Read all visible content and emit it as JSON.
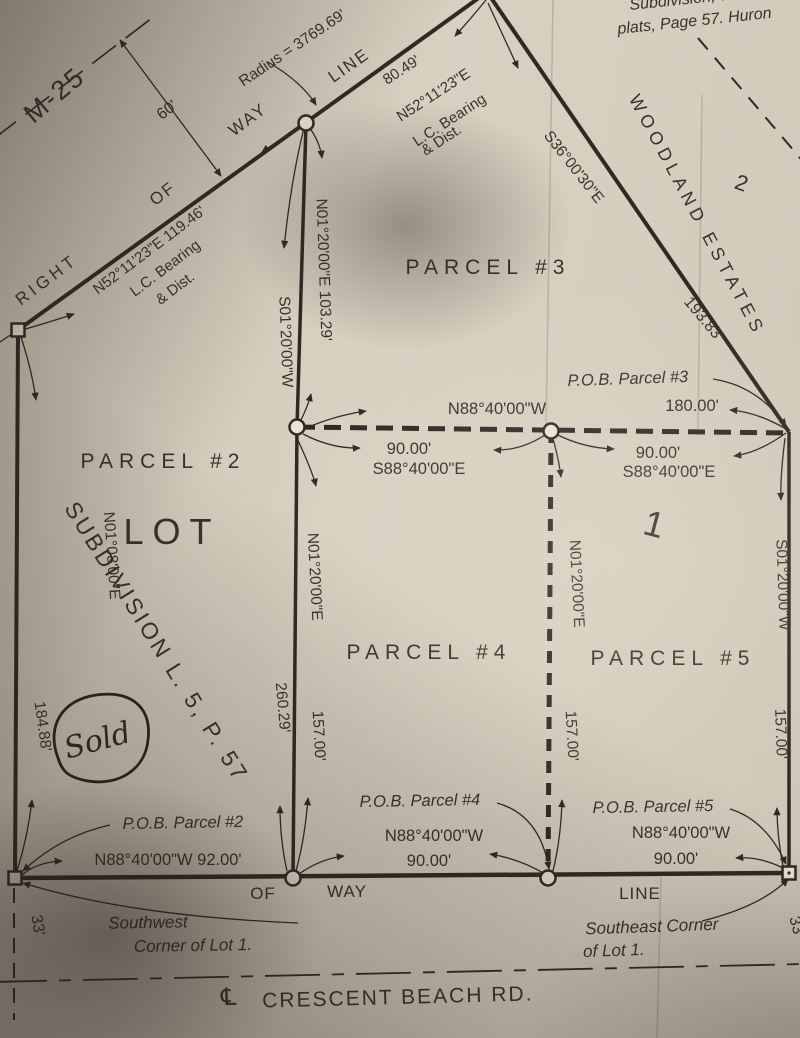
{
  "m25_road": {
    "name": "M-25",
    "right": "RIGHT",
    "of": "OF",
    "way": "WAY",
    "line": "LINE",
    "offset": "60'",
    "radius": "Radius = 3769.69'",
    "curve1": {
      "bearing_dist": "N52°11'23\"E  119.46'",
      "note1": "L.C. Bearing",
      "note2": "& Dist."
    },
    "curve2": {
      "dist": "80.49'",
      "bearing": "N52°11'23\"E",
      "note1": "L.C. Bearing",
      "note2": "& Dist."
    }
  },
  "plat_note": {
    "line1": "Subdivision, as Recor",
    "line2": "plats, Page 57. Huron"
  },
  "woodland": {
    "name": "WOODLAND ESTATES",
    "lot2": "2",
    "boundary_bearing": "S36°00'30\"E",
    "boundary_dist": "193.83'"
  },
  "parcel2": {
    "title": "PARCEL #2",
    "lot": "LOT",
    "subdivision": "SUBDIVISION  L.  5,  P.  57",
    "west_bearing": "N01°08'00\"E",
    "west_dist": "184.88'",
    "sold": "Sold",
    "pob": "P.O.B. Parcel #2",
    "south": "N88°40'00\"W 92.00'",
    "east_dist": "260.29'"
  },
  "parcel3": {
    "title": "PARCEL #3",
    "pob": "P.O.B. Parcel #3",
    "north_bearing": "N88°40'00\"W",
    "north_dist": "180.00'",
    "west_bearing_dist": "N01°20'00\"E  103.29'",
    "west_bearing_rev": "S01°20'00\"W"
  },
  "dashed_line": {
    "left_dist": "90.00'",
    "left_bearing": "S88°40'00\"E",
    "right_dist": "90.00'",
    "right_bearing": "S88°40'00\"E"
  },
  "parcel4": {
    "title": "PARCEL #4",
    "pob": "P.O.B. Parcel #4",
    "west_bearing": "N01°20'00\"E",
    "west_dist": "157.00'",
    "east_bearing": "N01°20'00\"E",
    "east_dist": "157.00'",
    "south_bearing": "N88°40'00\"W",
    "south_dist": "90.00'"
  },
  "parcel5": {
    "title": "PARCEL #5",
    "lot1": "1",
    "pob": "P.O.B. Parcel #5",
    "east_bearing": "S01°20'00\"W",
    "east_dist": "157.00'",
    "south_bearing": "N88°40'00\"W",
    "south_dist": "90.00'"
  },
  "south_row": {
    "of": "OF",
    "way": "WAY",
    "line": "LINE",
    "sw1": "Southwest",
    "sw2": "Corner of Lot 1.",
    "se1": "Southeast  Corner",
    "se2": "of Lot 1.",
    "left_33": "33'",
    "right_33": "33'"
  },
  "road": {
    "cl": "℄",
    "name": "CRESCENT BEACH RD."
  },
  "colors": {
    "paper": "#d6cfc0",
    "ink": "#2e2a23"
  }
}
